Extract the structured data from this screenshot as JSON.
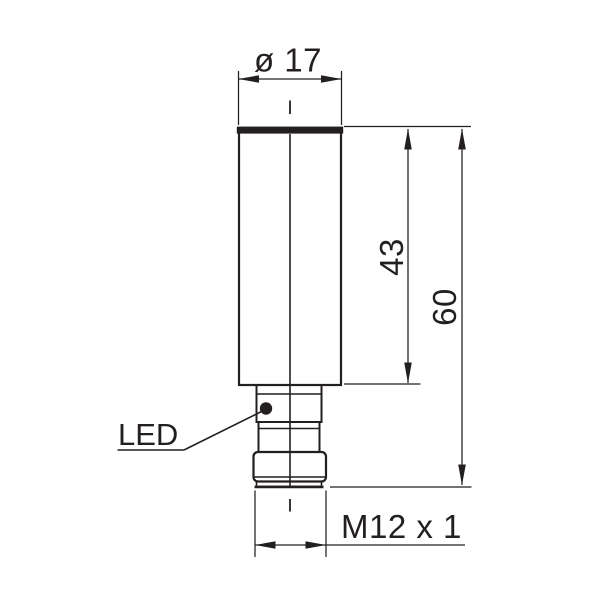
{
  "drawing": {
    "kind": "technical-dimension-drawing",
    "ink_color": "#231f20",
    "background_color": "#ffffff",
    "labels": {
      "diameter": "ø 17",
      "body_length": "43",
      "overall_length": "60",
      "thread": "M12 x 1",
      "led": "LED"
    }
  }
}
